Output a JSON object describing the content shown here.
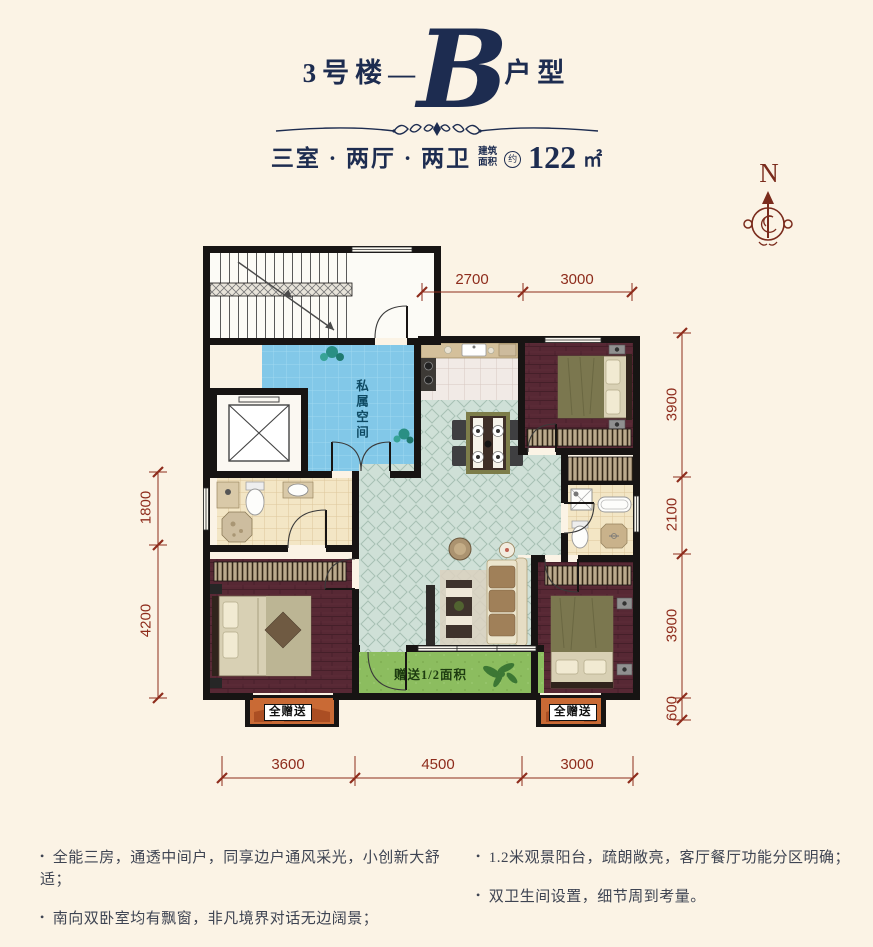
{
  "header": {
    "building": "3号楼",
    "dash": "—",
    "unit_letter": "B",
    "unit_suffix": "户型",
    "layout_text": "三室 · 两厅 · 两卫",
    "area_label_line1": "建筑",
    "area_label_line2": "面积",
    "area_approx": "约",
    "area_value": "122",
    "area_unit": "㎡"
  },
  "compass": {
    "north_label": "N"
  },
  "plan": {
    "labels": {
      "flex_space": "私属空间",
      "balcony_gift": "赠送1/2面积",
      "bay_left": "全赠送",
      "bay_right": "全赠送"
    },
    "dims": {
      "top": [
        "2700",
        "3000"
      ],
      "right": [
        "3900",
        "2100",
        "3900",
        "600"
      ],
      "left": [
        "1800",
        "4200"
      ],
      "bottom": [
        "3600",
        "4500",
        "3000"
      ]
    }
  },
  "features": {
    "left": [
      "全能三房，通透中间户，同享边户通风采光，小创新大舒适；",
      "南向双卧室均有飘窗，非凡境界对话无边阔景；"
    ],
    "right": [
      "1.2米观景阳台，疏朗敞亮，客厅餐厅功能分区明确；",
      "双卫生间设置，细节周到考量。"
    ]
  },
  "colors": {
    "background": "#fbf3e5",
    "title_navy": "#1d2c50",
    "dimension_red": "#8e2c1c",
    "compass_red": "#7a2b1c",
    "wall_black": "#171413",
    "flex_space_blue": "#82c8e8",
    "living_tile_teal": "#cfe0d7",
    "bedroom_plank": "#572834",
    "balcony_green": "#8cbd5f",
    "bay_orange": "#c96a35"
  }
}
